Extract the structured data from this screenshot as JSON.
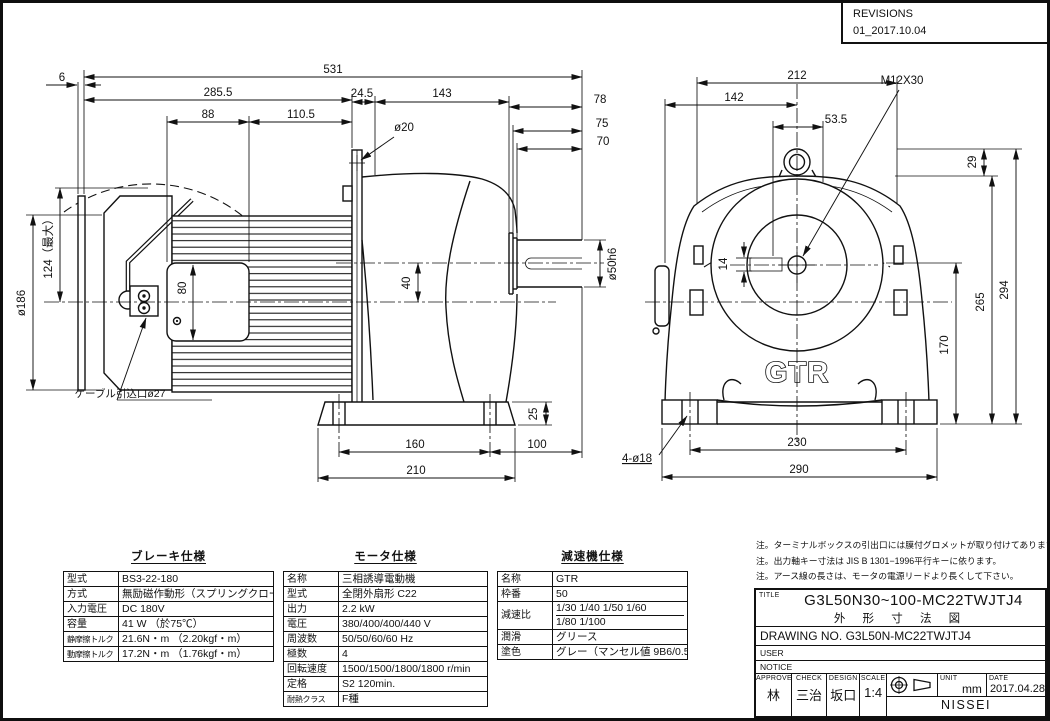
{
  "colors": {
    "line": "#111111",
    "paper": "#ffffff"
  },
  "revisions": {
    "title": "REVISIONS",
    "entry": "01_2017.10.04"
  },
  "dims": {
    "d6": "6",
    "d531": "531",
    "d285_5": "285.5",
    "d88": "88",
    "d110_5": "110.5",
    "d24_5": "24.5",
    "d143": "143",
    "d78": "78",
    "d75": "75",
    "d70": "70",
    "d40": "40",
    "d80": "80",
    "d25": "25",
    "d160": "160",
    "d210": "210",
    "d100": "100",
    "d212": "212",
    "d142": "142",
    "d53_5": "53.5",
    "d29": "29",
    "d294": "294",
    "d265": "265",
    "d170": "170",
    "d230": "230",
    "d290": "290",
    "d14": "14"
  },
  "labels": {
    "flange_hole": "ø20",
    "motor_od": "ø186",
    "lever_max": "124（最大）",
    "shaft_dia": "ø50h6",
    "cable_entry": "ケーブル引込口ø27",
    "eyebolt_tap": "M12X30",
    "base_holes": "4-ø18",
    "logo": "GTR"
  },
  "tables": {
    "brake": {
      "title": "ブレーキ仕様",
      "rows": [
        [
          "型式",
          "BS3-22-180"
        ],
        [
          "方式",
          "無励磁作動形（スプリングクローズ）"
        ],
        [
          "入力電圧",
          "DC 180V"
        ],
        [
          "容量",
          "41 W （於75℃）"
        ],
        [
          "静摩擦トルク",
          "21.6N・m （2.20kgf・m）"
        ],
        [
          "動摩擦トルク",
          "17.2N・m （1.76kgf・m）"
        ]
      ]
    },
    "motor": {
      "title": "モータ仕様",
      "rows": [
        [
          "名称",
          "三相誘導電動機"
        ],
        [
          "型式",
          "全閉外扇形 C22"
        ],
        [
          "出力",
          "2.2 kW"
        ],
        [
          "電圧",
          "380/400/400/440 V"
        ],
        [
          "周波数",
          "50/50/60/60 Hz"
        ],
        [
          "極数",
          "4"
        ],
        [
          "回転速度",
          "1500/1500/1800/1800 r/min"
        ],
        [
          "定格",
          "S2 120min."
        ],
        [
          "耐熱クラス",
          "F種"
        ]
      ]
    },
    "reducer": {
      "title": "減速機仕様",
      "rows": [
        [
          "名称",
          "GTR"
        ],
        [
          "枠番",
          "50"
        ],
        [
          "減速比",
          [
            "1/30 1/40 1/50 1/60",
            "1/80 1/100"
          ]
        ],
        [
          "潤滑",
          "グリース"
        ],
        [
          "塗色",
          "グレー（マンセル値 9B6/0.5）"
        ]
      ]
    }
  },
  "notes": [
    "注。ターミナルボックスの引出口には膜付グロメットが取り付けてあります。",
    "注。出力軸キー寸法は JIS B 1301−1996平行キーに依ります。",
    "注。アース線の長さは、モータの電源リードより長くして下さい。"
  ],
  "title_block": {
    "title_label": "TITLE",
    "title_line1": "G3L50N30~100-MC22TWJTJ4",
    "title_line2": "外 形 寸 法 図",
    "drawing_no_label": "DRAWING NO.",
    "drawing_no": "G3L50N-MC22TWJTJ4",
    "user_label": "USER",
    "notice_label": "NOTICE",
    "approve_label": "APPROVE",
    "approve": "林",
    "check_label": "CHECK",
    "check": "三治",
    "design_label": "DESIGN",
    "design": "坂口",
    "scale_label": "SCALE",
    "scale": "1:4",
    "unit_label": "UNIT",
    "unit": "mm",
    "date_label": "DATE",
    "date": "2017.04.28",
    "company": "NISSEI CORPORATION"
  }
}
